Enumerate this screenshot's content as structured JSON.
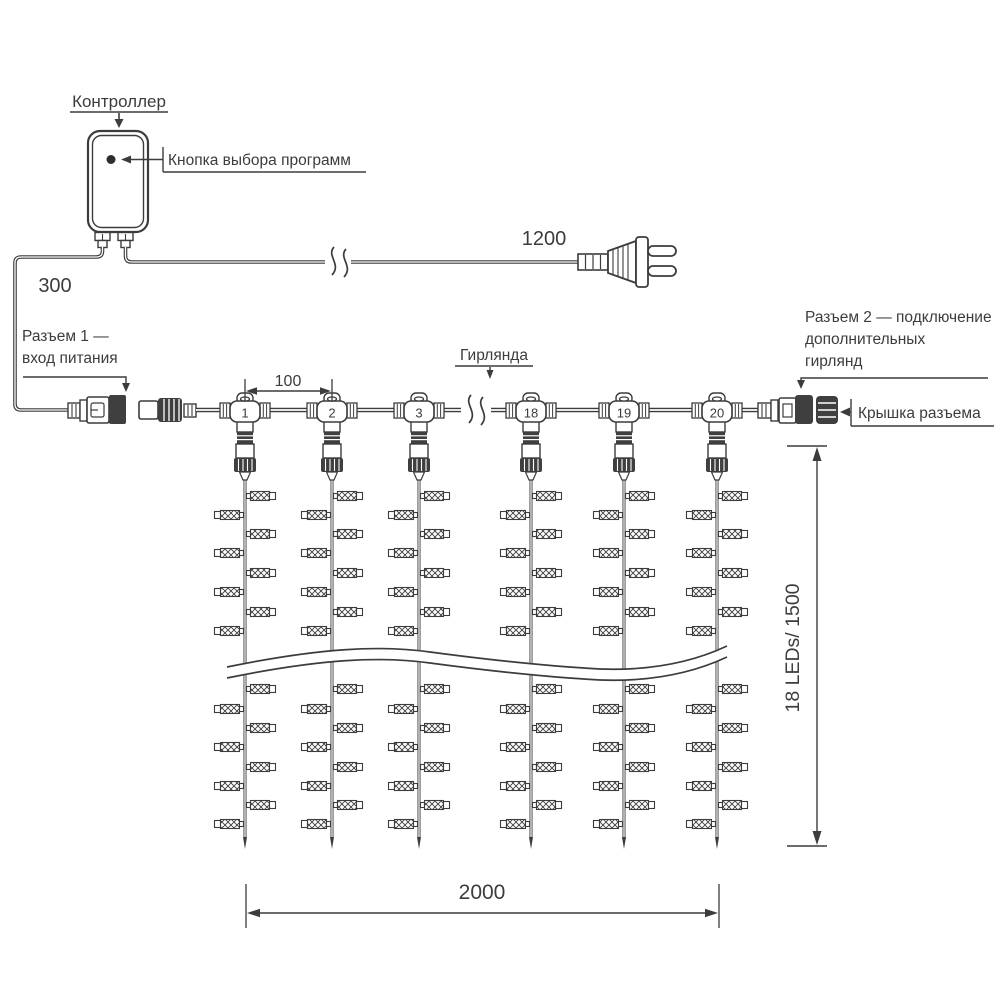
{
  "colors": {
    "line": "#3c3c3c",
    "dark": "#3f3f3f",
    "background": "#ffffff"
  },
  "labels": {
    "controller": "Контроллер",
    "program_button": "Кнопка выбора программ",
    "connector1": [
      "Разъем 1 —",
      "вход питания"
    ],
    "garland": "Гирлянда",
    "connector2": [
      "Разъем 2 — подключение",
      "дополнительных",
      "гирлянд"
    ],
    "connector_cap": "Крышка разъема"
  },
  "dimensions": {
    "lead_in_cable": "300",
    "power_cord": "1200",
    "drop_spacing": "100",
    "curtain_width": "2000",
    "strand_spec": "18 LEDs/ 1500"
  },
  "drops": [
    {
      "number": "1",
      "x": 245
    },
    {
      "number": "2",
      "x": 332
    },
    {
      "number": "3",
      "x": 419
    },
    {
      "number": "18",
      "x": 531
    },
    {
      "number": "19",
      "x": 624
    },
    {
      "number": "20",
      "x": 717
    }
  ],
  "lamp_rows": {
    "upper": [
      [
        496,
        "R"
      ],
      [
        515,
        "L"
      ],
      [
        534,
        "R"
      ],
      [
        553,
        "L"
      ],
      [
        573,
        "R"
      ],
      [
        592,
        "L"
      ],
      [
        612,
        "R"
      ],
      [
        631,
        "L"
      ]
    ],
    "lower": [
      [
        689,
        "R"
      ],
      [
        709,
        "L"
      ],
      [
        728,
        "R"
      ],
      [
        747,
        "L"
      ],
      [
        767,
        "R"
      ],
      [
        786,
        "L"
      ],
      [
        805,
        "R"
      ],
      [
        824,
        "L"
      ]
    ]
  }
}
